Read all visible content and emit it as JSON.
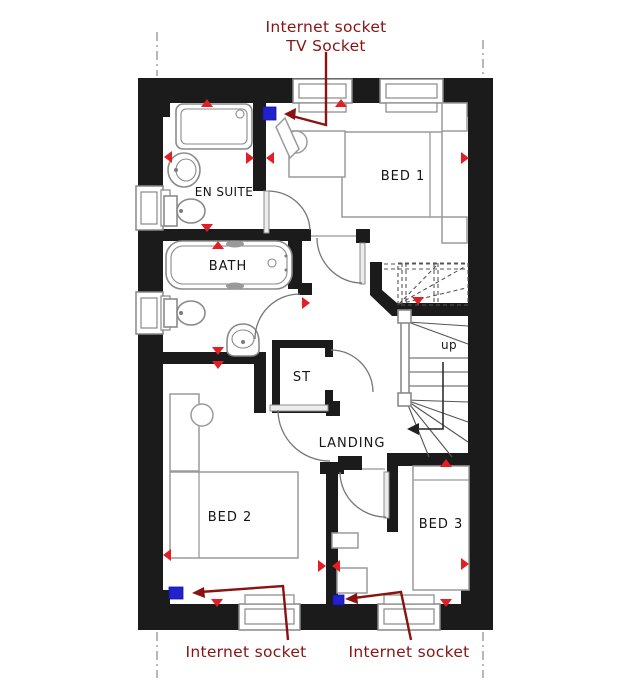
{
  "annotations": {
    "top_line1": "Internet socket",
    "top_line2": "TV Socket",
    "bottom_left": "Internet socket",
    "bottom_right": "Internet socket"
  },
  "rooms": {
    "bed1": "BED 1",
    "ensuite": "EN SUITE",
    "bath": "BATH",
    "storage": "ST",
    "landing": "LANDING",
    "bed2": "BED 2",
    "bed3": "BED 3"
  },
  "stairs": {
    "direction_label": "up"
  },
  "markers": {
    "power_socket_marker": "red-triangle",
    "internet_socket_marker": "blue-square"
  },
  "colors": {
    "wall_color": "#1b1b1b",
    "socket_red": "#e31e24",
    "internet_blue": "#2121cd",
    "annotation_red": "#8b1212",
    "fixture_gray": "#8a8a8a",
    "furniture_gray": "#9a9a9a",
    "window_gray": "#888888"
  }
}
